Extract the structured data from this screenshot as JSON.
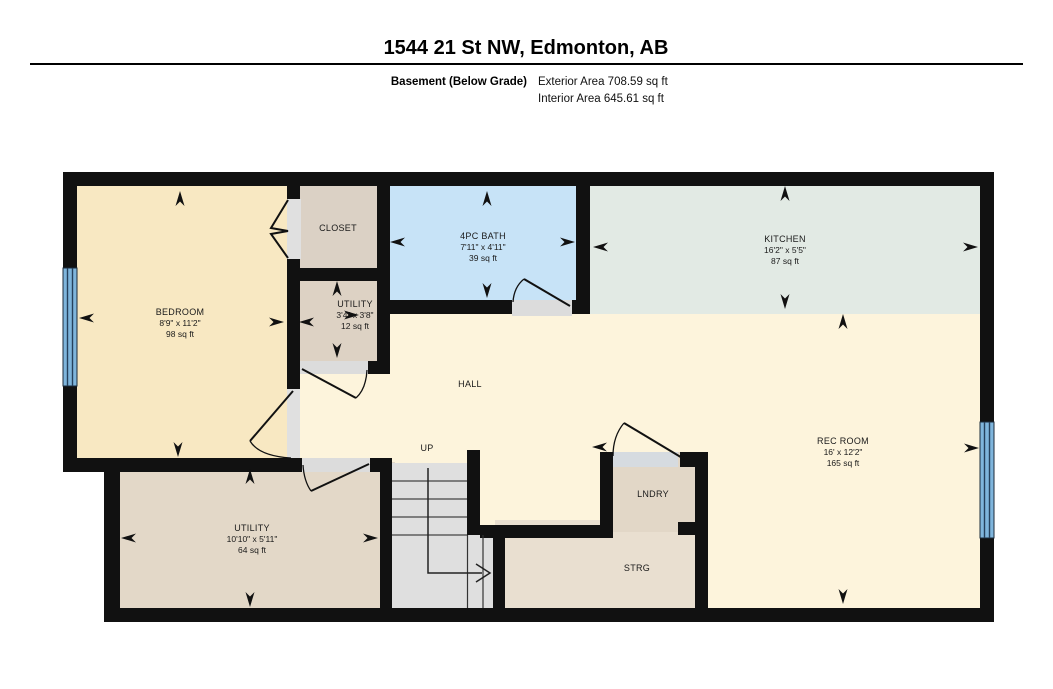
{
  "header": {
    "title": "1544 21 St NW, Edmonton, AB",
    "floor_label": "Basement (Below Grade)",
    "exterior_area": "Exterior Area 708.59 sq ft",
    "interior_area": "Interior Area 645.61 sq ft"
  },
  "rooms": {
    "bedroom": {
      "name": "BEDROOM",
      "dims": "8'9\" x 11'2\"",
      "area": "98 sq ft"
    },
    "closet": {
      "name": "CLOSET"
    },
    "utility_small": {
      "name": "UTILITY",
      "dims": "3'4\" x 3'8\"",
      "area": "12 sq ft"
    },
    "bath": {
      "name": "4PC BATH",
      "dims": "7'11\" x 4'11\"",
      "area": "39 sq ft"
    },
    "kitchen": {
      "name": "KITCHEN",
      "dims": "16'2\" x 5'5\"",
      "area": "87 sq ft"
    },
    "hall": {
      "name": "HALL"
    },
    "rec_room": {
      "name": "REC ROOM",
      "dims": "16' x 12'2\"",
      "area": "165 sq ft"
    },
    "utility_large": {
      "name": "UTILITY",
      "dims": "10'10\" x 5'11\"",
      "area": "64 sq ft"
    },
    "laundry": {
      "name": "LNDRY"
    },
    "storage": {
      "name": "STRG"
    },
    "stairs": {
      "name": "UP"
    }
  },
  "colors": {
    "wall": "#111111",
    "hall": "#FDF4DC",
    "bedroom": "#F8E8C2",
    "closet": "#DBD1C5",
    "utility_small": "#DDD2C4",
    "bath": "#C7E3F7",
    "kitchen": "#E2EAE4",
    "utility_large": "#E3D8C8",
    "stairs": "#DFDFDF",
    "storage": "#E9DFD0",
    "laundry": "#E2D7C7",
    "window": "#7FB5DC"
  }
}
